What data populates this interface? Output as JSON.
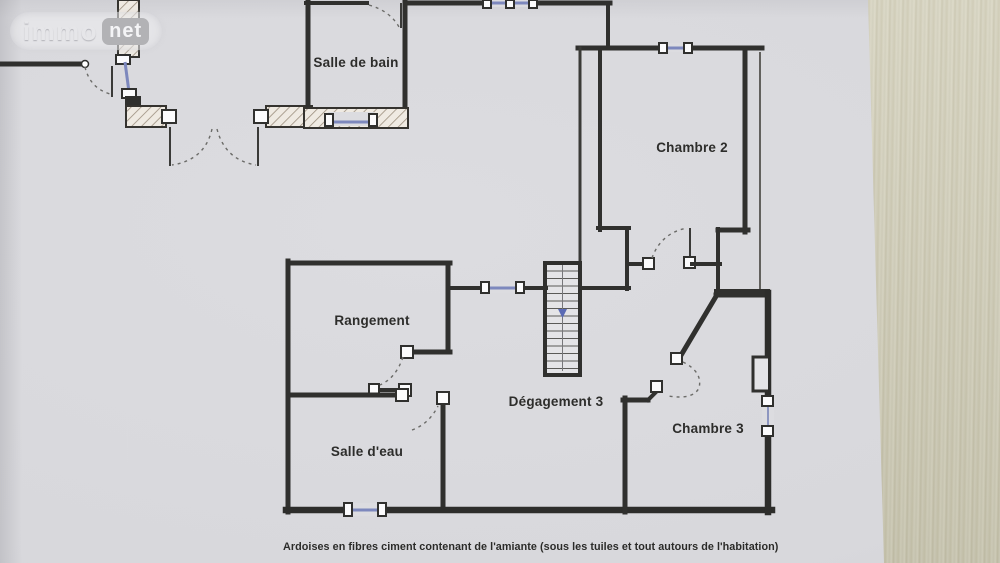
{
  "watermark": {
    "brand_left": "immo",
    "brand_right": "net"
  },
  "rooms": [
    {
      "label": "Salle de bain"
    },
    {
      "label": "Chambre 2"
    },
    {
      "label": "Rangement"
    },
    {
      "label": "Dégagement 3"
    },
    {
      "label": "Chambre 3"
    },
    {
      "label": "Salle d'eau"
    }
  ],
  "caption": "Ardoises en fibres ciment contenant de l'amiante (sous les tuiles et tout autours de l'habitation)",
  "colors": {
    "paper": "#dadade",
    "wall": "#30302e",
    "window_blue": "#7d88bd",
    "stair_arrow": "#5b6bb5",
    "wood_surface": "#d5d2bf",
    "watermark_box": "#b2b2b5"
  }
}
